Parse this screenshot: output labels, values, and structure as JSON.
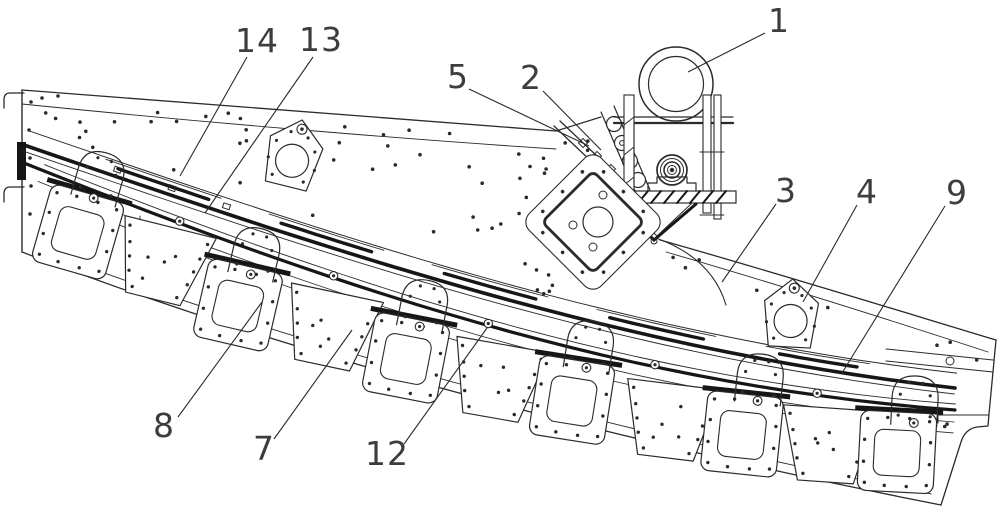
{
  "figure": {
    "background": "#ffffff",
    "line_color": "#2b2b2b",
    "rail_color": "#161616",
    "label_color": "#3d3d3d"
  },
  "callouts": [
    {
      "label": "1"
    },
    {
      "label": "2"
    },
    {
      "label": "3"
    },
    {
      "label": "4"
    },
    {
      "label": "5"
    },
    {
      "label": "7"
    },
    {
      "label": "8"
    },
    {
      "label": "9"
    },
    {
      "label": "12"
    },
    {
      "label": "13"
    },
    {
      "label": "14"
    }
  ]
}
